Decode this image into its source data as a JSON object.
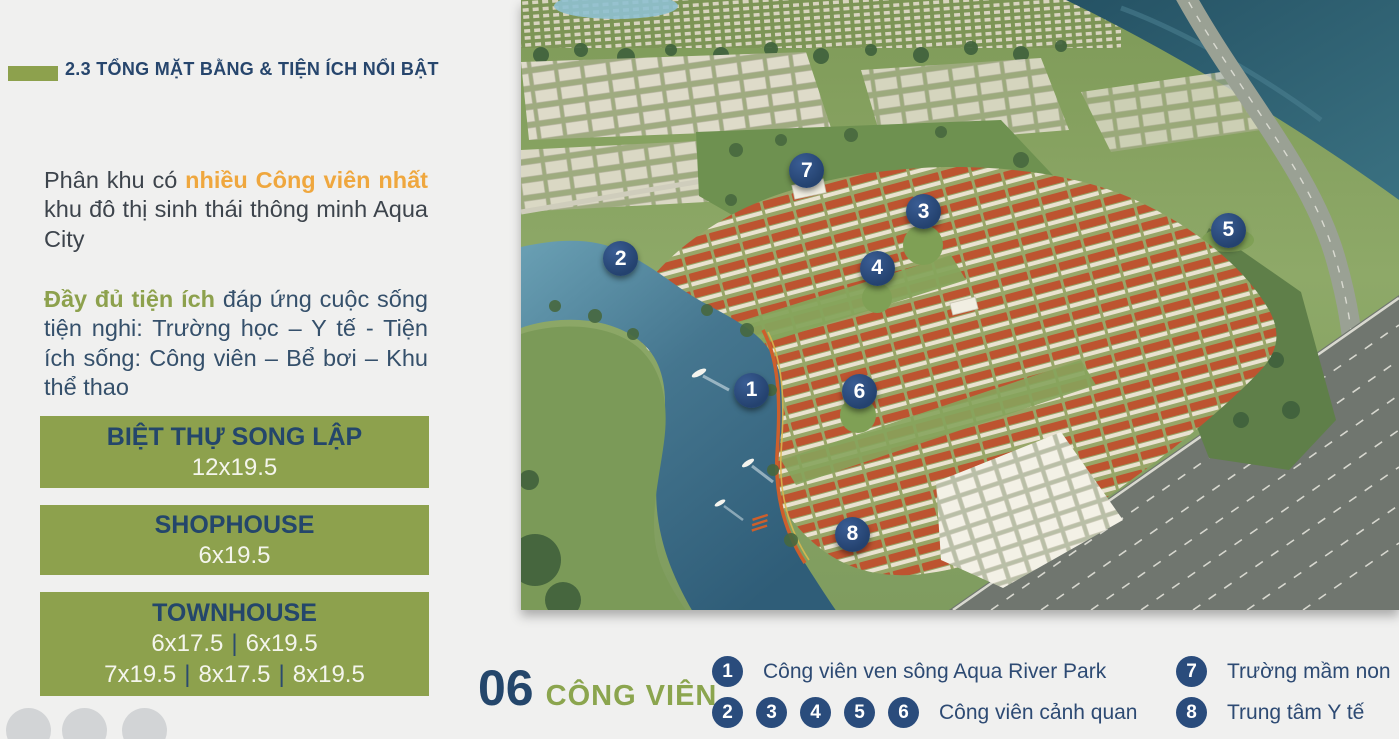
{
  "header": {
    "title": "2.3 TỔNG MẶT BẰNG & TIỆN ÍCH NỔI BẬT"
  },
  "intro": {
    "p1": {
      "pre": "Phân khu có ",
      "highlight": "nhiều Công viên nhất",
      "post": " khu đô thị sinh thái thông minh Aqua City"
    },
    "p2": {
      "highlight": "Đầy đủ tiện ích",
      "rest": " đáp ứng cuộc sống tiện nghi: Trường học – Y tế - Tiện ích sống: Công viên – Bể bơi – Khu thể thao"
    }
  },
  "products": [
    {
      "title": "BIỆT THỰ SONG LẬP",
      "size_lines": [
        [
          "12x19.5"
        ]
      ]
    },
    {
      "title": "SHOPHOUSE",
      "size_lines": [
        [
          "6x19.5"
        ]
      ]
    },
    {
      "title": "TOWNHOUSE",
      "size_lines": [
        [
          "6x17.5",
          "6x19.5"
        ],
        [
          "7x19.5",
          "8x17.5",
          "8x19.5"
        ]
      ]
    }
  ],
  "parks_counter": {
    "number": "06",
    "label": "CÔNG VIÊN"
  },
  "legend": {
    "left_rows": [
      {
        "markers": [
          "1"
        ],
        "label": "Công viên ven sông Aqua River Park"
      },
      {
        "markers": [
          "2",
          "3",
          "4",
          "5",
          "6"
        ],
        "label": "Công viên cảnh quan"
      }
    ],
    "right_rows": [
      {
        "markers": [
          "7"
        ],
        "label": "Trường mầm non"
      },
      {
        "markers": [
          "8"
        ],
        "label": "Trung tâm Y tế"
      }
    ]
  },
  "map": {
    "markers": [
      {
        "n": "1",
        "x": 26.2,
        "y": 63.9
      },
      {
        "n": "2",
        "x": 11.3,
        "y": 42.3
      },
      {
        "n": "3",
        "x": 45.8,
        "y": 34.6
      },
      {
        "n": "4",
        "x": 40.5,
        "y": 43.9
      },
      {
        "n": "5",
        "x": 80.5,
        "y": 37.7
      },
      {
        "n": "6",
        "x": 38.5,
        "y": 64.1
      },
      {
        "n": "7",
        "x": 32.5,
        "y": 27.9
      },
      {
        "n": "8",
        "x": 37.7,
        "y": 87.5
      }
    ]
  },
  "pager": {
    "dot_count": 3
  },
  "colors": {
    "accent_green": "#8da14d",
    "navy": "#27466d",
    "orange_highlight": "#efa73e",
    "body_text": "#3d444c",
    "legend_navy": "#2d4a73",
    "marker_bg": "#2a4c7c",
    "background": "#f0f0ef"
  }
}
